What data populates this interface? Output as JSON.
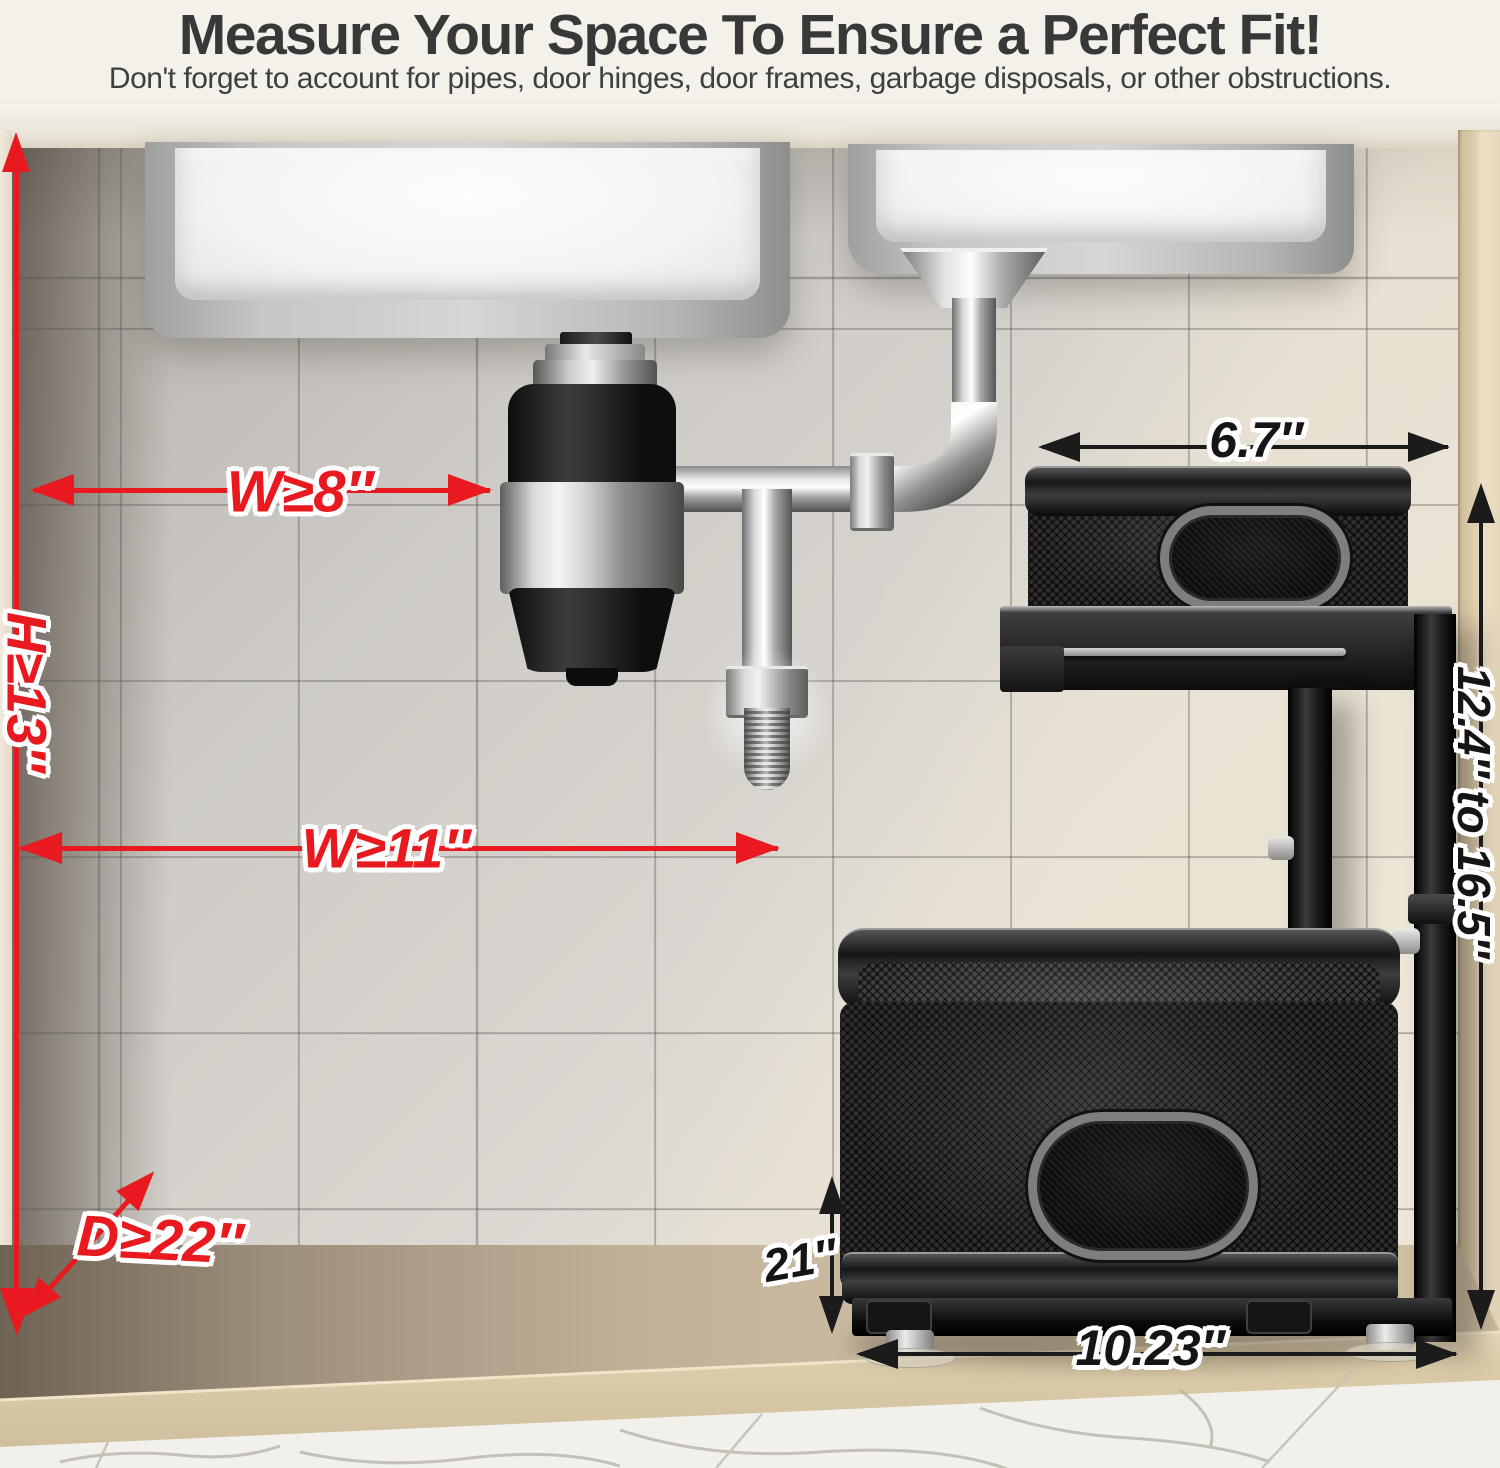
{
  "header": {
    "title": "Measure Your Space To Ensure a Perfect Fit!",
    "subtitle": "Don't forget to account for pipes, door hinges, door frames, garbage disposals, or other obstructions."
  },
  "palette": {
    "annotation_red": "#e8191f",
    "annotation_black": "#1b1b1b",
    "cabinet_wood": "#d8c9ab",
    "tile_grey": "#d3d0cb",
    "organizer_black": "#1e1e1e"
  },
  "measurements": {
    "cabinet_space": [
      {
        "id": "min-width-at-disposal",
        "label": "W≥8″"
      },
      {
        "id": "min-height",
        "label": "H≥13″"
      },
      {
        "id": "min-width-lower",
        "label": "W≥11″"
      },
      {
        "id": "min-depth",
        "label": "D≥22″"
      }
    ],
    "organizer": [
      {
        "id": "top-basket-width",
        "label": "6.7″"
      },
      {
        "id": "adjustable-height-range",
        "label": "12.4″ to 16.5″"
      },
      {
        "id": "basket-depth",
        "label": "21″"
      },
      {
        "id": "bottom-basket-width",
        "label": "10.23″"
      }
    ]
  }
}
